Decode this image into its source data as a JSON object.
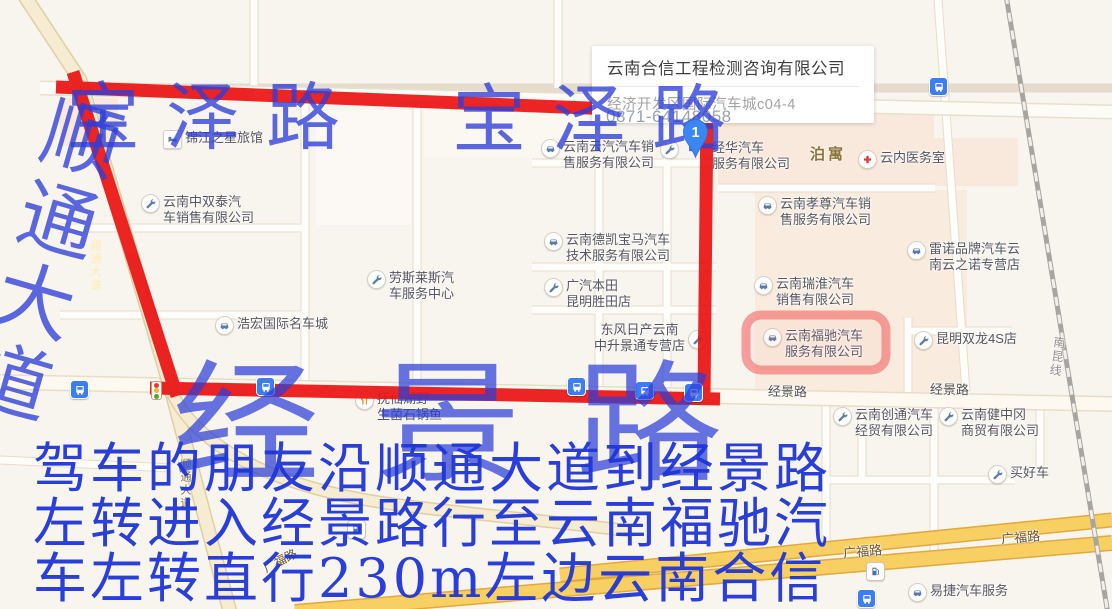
{
  "popup": {
    "title": "云南合信工程检测咨询有限公司",
    "address": "经济开发区国际汽车城c04-4",
    "phone": "0871-64148058"
  },
  "marker": {
    "label": "1"
  },
  "annotations": {
    "baoze_left": "宝泽路",
    "baoze_right": "宝泽路",
    "shuntong_vertical": "顺通大道",
    "jingjing_big": "经景路",
    "directions_line1": "驾车的朋友沿顺通大道到经景路",
    "directions_line2": "左转进入经景路行至云南福驰汽",
    "directions_line3": "车左转直行230m左边云南合信",
    "ink_color": "#2b3ed8",
    "route_color": "#ea1212",
    "highlight_color": "#f25a5a"
  },
  "road_labels": {
    "jingjing_1": "经景路",
    "jingjing_2": "经景路",
    "guangfu_1": "广福路",
    "guangfu_2": "广福路",
    "guangfu_3": "广福路",
    "shuntong_on_road": "顺通大道",
    "shuntong_on_route": "顺通大道",
    "railway": "南昆线"
  },
  "areas": {
    "boyu": "泊寓"
  },
  "icons": {
    "car": "car-glyph",
    "wrench": "wrench-glyph",
    "hotel": "bed-glyph",
    "hospital": "red-cross-glyph",
    "restaurant": "fork-knife-glyph",
    "fuel": "fuel-pump-glyph",
    "bus": "bus-glyph",
    "traffic_light": "traffic-light-glyph"
  },
  "pois": [
    {
      "icon": "hotel",
      "line1": "锦江之星旅馆",
      "line2": ""
    },
    {
      "icon": "wrench",
      "line1": "云南中双泰汽",
      "line2": "车销售有限公司"
    },
    {
      "icon": "car",
      "line1": "云南云汽汽车销",
      "line2": "售服务有限公司"
    },
    {
      "icon": "wrench",
      "line1": "经华汽车",
      "line2": "服务有限公司"
    },
    {
      "icon": "hospital",
      "line1": "云内医务室",
      "line2": ""
    },
    {
      "icon": "car",
      "line1": "云南孝尊汽车销",
      "line2": "售服务有限公司"
    },
    {
      "icon": "car",
      "line1": "雷诺品牌汽车云",
      "line2": "南云之诺专营店"
    },
    {
      "icon": "car",
      "line1": "云南瑞淮汽车",
      "line2": "销售有限公司"
    },
    {
      "icon": "car",
      "line1": "云南德凯宝马汽车",
      "line2": "技术服务有限公司"
    },
    {
      "icon": "wrench",
      "line1": "广汽本田",
      "line2": "昆明胜田店"
    },
    {
      "icon": "wrench",
      "line1": "劳斯莱斯汽",
      "line2": "车服务中心"
    },
    {
      "icon": "car",
      "line1": "浩宏国际名车城",
      "line2": ""
    },
    {
      "icon": "wrench",
      "line1": "东风日产云南",
      "line2": "中升景通专营店"
    },
    {
      "icon": "car",
      "line1": "云南福驰汽车",
      "line2": "服务有限公司"
    },
    {
      "icon": "wrench",
      "line1": "昆明双龙4S店",
      "line2": ""
    },
    {
      "icon": "wrench",
      "line1": "云南创通汽车",
      "line2": "经贸有限公司"
    },
    {
      "icon": "wrench",
      "line1": "云南健中冈",
      "line2": "商贸有限公司"
    },
    {
      "icon": "wrench",
      "line1": "买好车",
      "line2": ""
    },
    {
      "icon": "restaurant",
      "line1": "抚仙湖野",
      "line2": "生菌石锅鱼"
    },
    {
      "icon": "car",
      "line1": "易捷汽车服务",
      "line2": ""
    }
  ]
}
